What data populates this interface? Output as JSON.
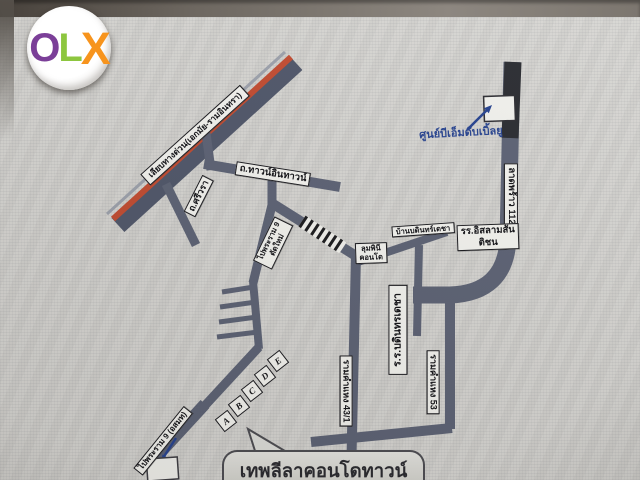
{
  "logo": {
    "letters": [
      {
        "char": "O",
        "color": "#7b3f98"
      },
      {
        "char": "L",
        "color": "#8dc63f"
      },
      {
        "char": "X",
        "color": "#f7941d"
      }
    ]
  },
  "map": {
    "colors": {
      "road": "#5a6073",
      "expressway": "#4d5468",
      "expressway_stripe": "#c2492e",
      "annotation_blue": "#23408f",
      "label_bg": "#f4f4f0"
    },
    "labels": {
      "expressway": "เลียบทางด่วน(เอกมัย-รามอินทรา)",
      "si_wara": "ถ.ศรีวรา",
      "town_in_town": "ถ.ทาวน์อินทาวน์",
      "rama9_new": {
        "line1": "ไปพระราม 9",
        "line2": "ตัดใหม่"
      },
      "lat_phrao_112": "ลาดพร้าว 112",
      "bmw_center": "ศูนย์บีเอ็มดับเบิ้ลยู",
      "islam_school": {
        "line1": "รร.อิสลามสัน",
        "line2": "ติชน"
      },
      "baan_bodin": "บ้านบดินทร์เดชา",
      "lumpini_condo": {
        "line1": "ลุมพินี",
        "line2": "คอนโด"
      },
      "bodindecha_school": "ร.ร.บดินทรเดชา",
      "ramkhamhaeng_43_1": "รามคำแหง 43/1",
      "ramkhamhaeng_53": "รามคำแหง 53",
      "to_rama9": "ไปพระราม 9 (อสมท)",
      "destination": "เทพลีลาคอนโดทาวน์",
      "building_markers": [
        "A",
        "B",
        "C",
        "D",
        "E"
      ]
    }
  }
}
